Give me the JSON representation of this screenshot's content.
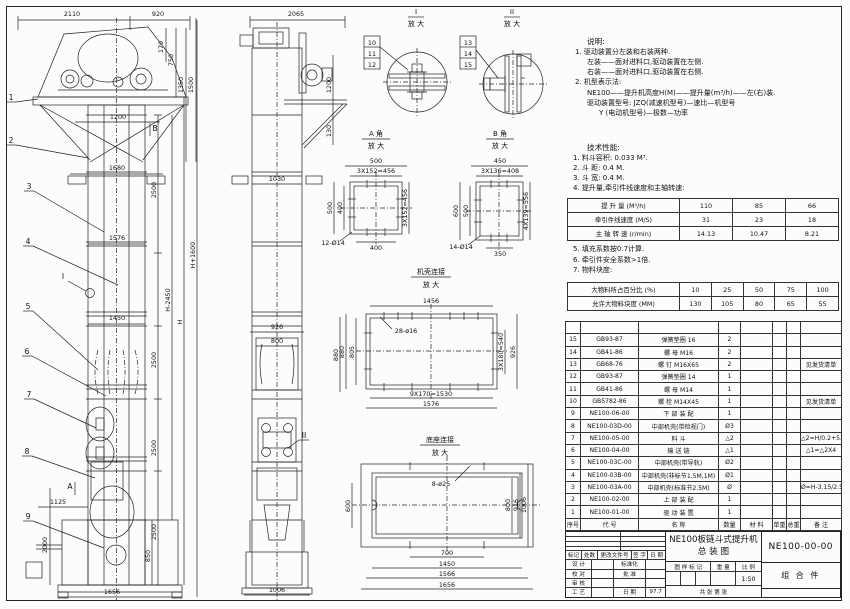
{
  "notes": {
    "heading": "说明:",
    "n1": "1. 驱动装置分左装和右装两种.",
    "n2": "左装——面对进料口,驱动装置在左侧.",
    "n3": "右装——面对进料口,驱动装置在右侧.",
    "n4": "2. 机型表示法:",
    "n5": "NE100——提升机高度H(M)——提升量(m³/h)——左(右)装.",
    "n6": "驱动装置型号: JZQ(减速机型号)—速比—机型号",
    "n7": "Y (电动机型号)—极数—功率",
    "tech_heading": "技术性能:",
    "t1": "1. 料斗容积: 0.033 M³.",
    "t2": "2. 斗  距: 0.4 M.",
    "t3": "3. 斗  宽: 0.4 M.",
    "t4": "4. 提升量,牵引件线速度和主轴转速:",
    "p1": "5. 填充系数按0.7计算.",
    "p2": "6. 牵引件安全系数>1倍.",
    "p3": "7. 物料块度:"
  },
  "chart_data": [
    {
      "type": "table",
      "title": "提升量,牵引件线速度和主轴转速",
      "rows": [
        {
          "label": "提 升 量 (M³/h)",
          "values": [
            110,
            85,
            66
          ]
        },
        {
          "label": "牵引件线速度 (M/S)",
          "values": [
            31,
            23,
            18
          ]
        },
        {
          "label": "主 轴 转 速 (r/min)",
          "values": [
            14.13,
            10.47,
            8.21
          ]
        }
      ]
    },
    {
      "type": "table",
      "title": "物料块度",
      "rows": [
        {
          "label": "大物料所占百分比 (%)",
          "values": [
            10,
            25,
            50,
            75,
            100
          ]
        },
        {
          "label": "允许大物料块度 (MM)",
          "values": [
            130,
            105,
            80,
            65,
            55
          ]
        }
      ]
    }
  ],
  "cap": {
    "r1l": "提 升 量  (M³/h)",
    "r1v1": "110",
    "r1v2": "85",
    "r1v3": "66",
    "r2l": "牵引件线速度 (M/S)",
    "r2v1": "31",
    "r2v2": "23",
    "r2v3": "18",
    "r3l": "主 轴 转 速 (r/min)",
    "r3v1": "14.13",
    "r3v2": "10.47",
    "r3v3": "8.21"
  },
  "lump": {
    "r1l": "大物料所占百分比 (%)",
    "r1v1": "10",
    "r1v2": "25",
    "r1v3": "50",
    "r1v4": "75",
    "r1v5": "100",
    "r2l": "允许大物料块度 (MM)",
    "r2v1": "130",
    "r2v2": "105",
    "r2v3": "80",
    "r2v4": "65",
    "r2v5": "55"
  },
  "bom": {
    "h_no": "序号",
    "h_code": "代  号",
    "h_name": "名  称",
    "h_qty": "数量",
    "h_mat": "材  料",
    "h_uw": "单重",
    "h_tw": "总重",
    "h_rm": "备  注",
    "rows": [
      {
        "no": "15",
        "code": "GB93-87",
        "name": "弹簧垫圈 16",
        "qty": "2",
        "rm": ""
      },
      {
        "no": "14",
        "code": "GB41-86",
        "name": "螺  母  M16",
        "qty": "2",
        "rm": ""
      },
      {
        "no": "13",
        "code": "GB68-76",
        "name": "螺  钉  M16X65",
        "qty": "2",
        "rm": "见发货清单"
      },
      {
        "no": "12",
        "code": "GB93-87",
        "name": "弹簧垫圈 14",
        "qty": "1",
        "rm": ""
      },
      {
        "no": "11",
        "code": "GB41-86",
        "name": "螺  母  M14",
        "qty": "1",
        "rm": ""
      },
      {
        "no": "10",
        "code": "GB5782-86",
        "name": "螺  栓  M14X45",
        "qty": "1",
        "rm": "见发货清单"
      },
      {
        "no": "9",
        "code": "NE100-06-00",
        "name": "下 部 装 配",
        "qty": "1",
        "rm": ""
      },
      {
        "no": "8",
        "code": "NE100-03D-00",
        "name": "中部机壳(带检视门)",
        "qty": "Ø3",
        "rm": ""
      },
      {
        "no": "7",
        "code": "NE100-05-00",
        "name": "料  斗",
        "qty": "△2",
        "rm": "△2=H/0.2+5.75"
      },
      {
        "no": "6",
        "code": "NE100-04-00",
        "name": "输 送 链",
        "qty": "△1",
        "rm": "△1=△2X4"
      },
      {
        "no": "5",
        "code": "NE100-03C-00",
        "name": "中部机壳(带导轨)",
        "qty": "Ø2",
        "rm": ""
      },
      {
        "no": "4",
        "code": "NE100-03B-00",
        "name": "中部机壳(非标节1.5M,1M)",
        "qty": "Ø1",
        "rm": ""
      },
      {
        "no": "3",
        "code": "NE100-03A-00",
        "name": "中部机壳(标准节2.5M)",
        "qty": "Ø",
        "rm": "Ø=H-3.15/2.5"
      },
      {
        "no": "2",
        "code": "NE100-02-00",
        "name": "上 部 装 配",
        "qty": "1",
        "rm": ""
      },
      {
        "no": "1",
        "code": "NE100-01-00",
        "name": "驱 动 装 置",
        "qty": "1",
        "rm": ""
      }
    ]
  },
  "tb": {
    "c1": "标记",
    "c2": "处数",
    "c3": "更改文件号",
    "c4": "签 字",
    "c5": "日 期",
    "design": "设 计",
    "std": "标准化",
    "check": "校 对",
    "approve": "批 准",
    "audit": "审 核",
    "craft": "工 艺",
    "date_l": "日 期",
    "date": "97.7",
    "mark_l": "图 样 标 记",
    "weight_l": "重 量",
    "scale_l": "比 例",
    "scale": "1:50",
    "sheets": "共  张  第  张",
    "title1": "NE100板链斗式提升机",
    "title2": "总  装  图",
    "no": "NE100-00-00",
    "part": "组 合 件"
  },
  "cad": {
    "front": {
      "d2110": "2110",
      "d920": "920",
      "d170": "170",
      "d750": "750",
      "d1350": "1350",
      "d1500": "1500",
      "d1200": "1200",
      "d1680": "1680",
      "d2500a": "2500",
      "d1576": "1576",
      "d1450": "1450",
      "d2500b": "2500",
      "d2500c": "2500",
      "d2500d": "2500",
      "dHm": "H-2450",
      "dH": "H",
      "dHp": "H+1600",
      "d850": "850",
      "d2000": "2000",
      "d1125": "1125",
      "d1656": "1656",
      "c1": "1",
      "c2": "2",
      "c3": "3",
      "c4": "4",
      "c5": "5",
      "c6": "6",
      "c7": "7",
      "c8": "8",
      "c9": "9",
      "mA": "A",
      "mB": "B",
      "mI": "I"
    },
    "side": {
      "d2065": "2065",
      "d1200": "1200",
      "d130": "130",
      "d1030": "1030",
      "d926": "926",
      "d800": "800",
      "d880": "880",
      "d1006": "1006",
      "mII": "II"
    },
    "di": {
      "t": "I",
      "s": "放 大",
      "c10": "10",
      "c11": "11",
      "c12": "12"
    },
    "dii": {
      "t": "II",
      "s": "放 大",
      "c13": "13",
      "c14": "14",
      "c15": "15"
    },
    "ca": {
      "t1": "A 角",
      "t2": "放 大",
      "top1": "500",
      "top2": "3X152=456",
      "left1": "500",
      "left2": "400",
      "right1": "3X152=456",
      "bot": "400",
      "holes": "12-Ø14"
    },
    "cb": {
      "t1": "B 角",
      "t2": "放 大",
      "top1": "450",
      "top2": "3X136=408",
      "left1": "600",
      "left2": "500",
      "right1": "4X139=556",
      "bot": "350",
      "holes": "14-Ø14"
    },
    "sh": {
      "t1": "机壳连接",
      "t2": "放 大",
      "top": "1456",
      "holes": "28-ø16",
      "left1": "880",
      "left2": "805",
      "right1": "3X180=540",
      "right2": "926",
      "bot1": "9X170=1530",
      "bot2": "1576"
    },
    "bs": {
      "t1": "底座连接",
      "t2": "放 大",
      "holes": "8-ø25",
      "left1": "600",
      "right1": "800",
      "right2": "916",
      "right3": "1006",
      "bot1": "700",
      "bot2": "1450",
      "bot3": "1566",
      "bot4": "1656"
    }
  }
}
